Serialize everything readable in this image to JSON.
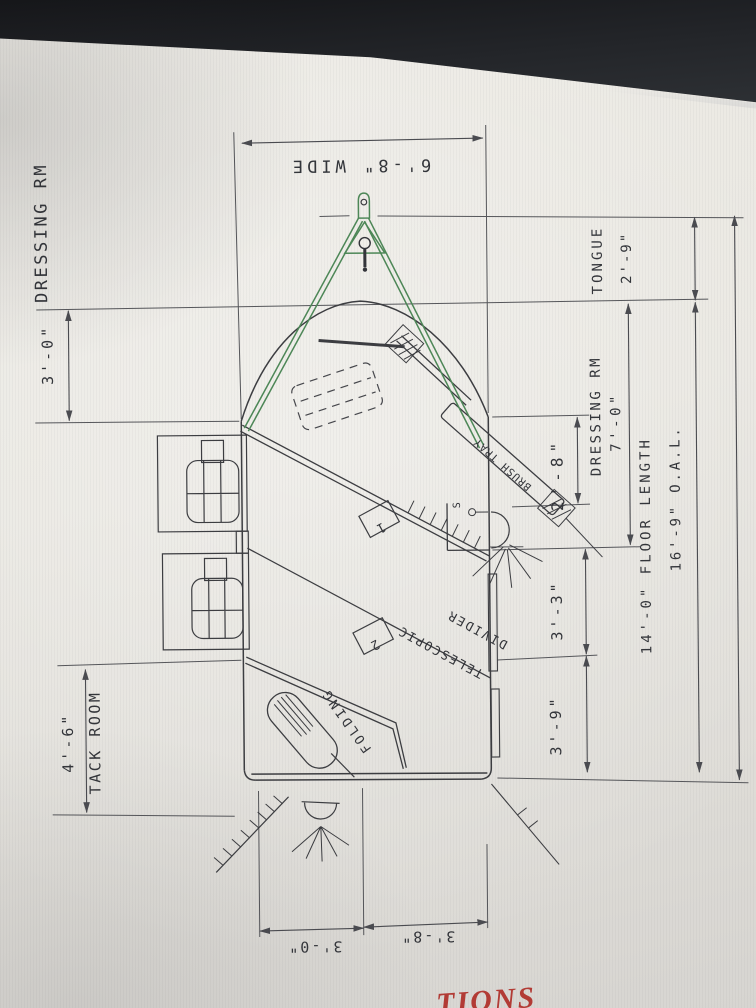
{
  "screen": {
    "caption_fragment": "TIONS"
  },
  "drawing": {
    "title_context": "horse trailer floor plan",
    "colors": {
      "line": "#3c3d41",
      "dimension_line": "#4a4b50",
      "hitch_green": "#4d8757",
      "caption_red": "#b23b35",
      "screen_bg": "#e8e6e1",
      "bezel": "#1c1e22"
    },
    "labels": {
      "dressing_rm_left": "DRESSING RM",
      "dim_front": "3'-0\"",
      "width": "6'-8\" WIDE",
      "tongue_label": "TONGUE",
      "tongue_dim": "2'-9\"",
      "dressing_rm_right": "DRESSING RM",
      "dressing_rm_dim": "7'-0\"",
      "dim_brush_wall": "2'-8\"",
      "floor_length": "14'-0\" FLOOR LENGTH",
      "overall_length": "16'-9\" O.A.L.",
      "dim_stall_rear": "3'-3\"",
      "dim_rear": "3'-9\"",
      "tack_dim": "4'-6\"",
      "tack_room": "TACK ROOM",
      "dim_bottom_left": "3'-0\"",
      "dim_bottom_right": "3'-8\"",
      "telescopic": "TELESCOPIC",
      "divider": "DIVIDER",
      "folding": "FOLDING",
      "brush_tray": "BRUSH TRAY",
      "stall_1": "1",
      "stall_2": "2",
      "switch_symbol": "S"
    }
  }
}
